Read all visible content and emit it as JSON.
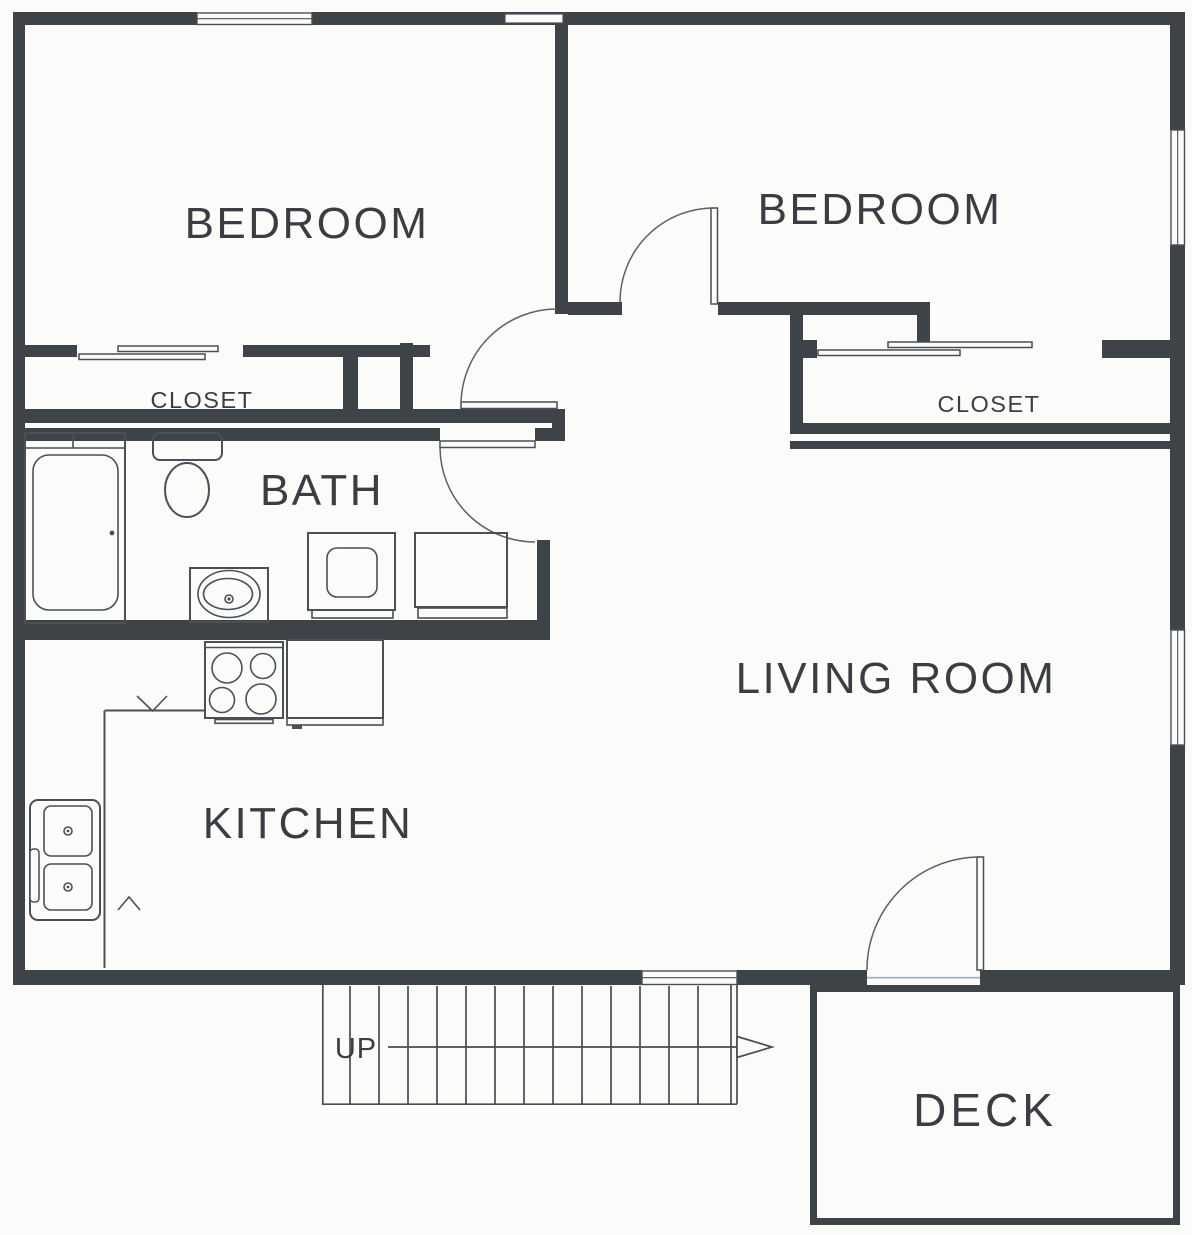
{
  "drawing": {
    "type": "floor-plan",
    "labels": {
      "bedroom_left": "BEDROOM",
      "bedroom_right": "BEDROOM",
      "closet_left": "CLOSET",
      "closet_right": "CLOSET",
      "bath": "BATH",
      "kitchen": "KITCHEN",
      "living_room": "LIVING ROOM",
      "deck": "DECK",
      "stairs_direction": "UP"
    },
    "colors": {
      "wall": "#3e4347",
      "fixture_line": "#4b5056",
      "label_text": "#3a3e42",
      "background": "#fbfbfa",
      "threshold": "#9fb0bd"
    }
  }
}
